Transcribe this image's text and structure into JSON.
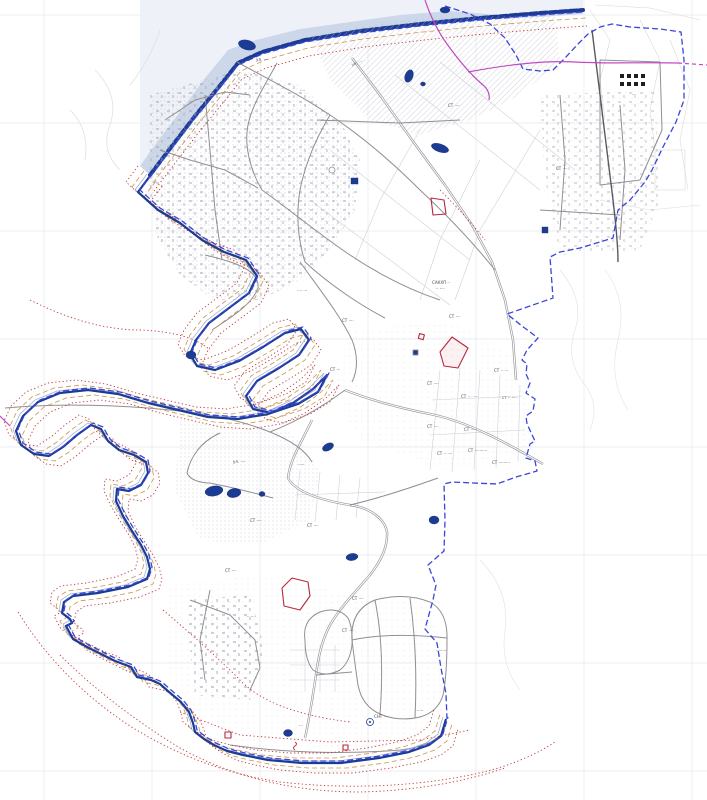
{
  "map": {
    "kind": "cadastral-boundary-plan",
    "colors": {
      "background": "#ffffff",
      "grid": "#e7e8ec",
      "terrain_outside": "#eef1f7",
      "water_light": "#ccd7ea",
      "water_navy": "#1c3c94",
      "water_edge": "#99a7d6",
      "boundary_blue": "#3b46d8",
      "zone_red": "#c23a3a",
      "zone_tan": "#c9964f",
      "route_magenta": "#c24ac2",
      "road_gray": "#8f8f94",
      "road_dark": "#5a5a60",
      "parcel_gray": "#cdd0d8",
      "contour_gray": "#dfe1e8",
      "urban_speckle": "#b9bfca",
      "building_gray": "#9aa0ac",
      "plot_red": "#b5283c",
      "label_gray": "#4a4a55"
    },
    "features": [
      {
        "name": "city-boundary",
        "style": "blue-dashed-line"
      },
      {
        "name": "shoreline",
        "style": "navy-solid-line"
      },
      {
        "name": "river",
        "style": "light-blue-band-with-navy-bank"
      },
      {
        "name": "protection-zone",
        "style": "red-dotted-line"
      },
      {
        "name": "coastal-strip-zone",
        "style": "tan-dashed-line"
      },
      {
        "name": "planned-route",
        "style": "magenta-line"
      },
      {
        "name": "road-network",
        "style": "gray-double-lines"
      },
      {
        "name": "built-up-area",
        "style": "gray-speckle-texture"
      },
      {
        "name": "ponds",
        "style": "navy-filled-shapes"
      },
      {
        "name": "red-outlined-plots",
        "style": "red-outline-polygons"
      },
      {
        "name": "railway",
        "style": "dark-gray-line"
      },
      {
        "name": "map-sheet-grid",
        "style": "light-gray-grid"
      }
    ],
    "labels": [
      {
        "text": "ул. ····",
        "x": 256,
        "y": 61,
        "rot": 0
      },
      {
        "text": "ул. ···",
        "x": 352,
        "y": 66,
        "rot": -20
      },
      {
        "text": "····",
        "x": 300,
        "y": 92,
        "rot": 0
      },
      {
        "text": "СТ ····",
        "x": 448,
        "y": 107,
        "rot": 0
      },
      {
        "text": "···",
        "x": 632,
        "y": 96,
        "rot": 0
      },
      {
        "text": "СТ ····",
        "x": 556,
        "y": 170,
        "rot": 0
      },
      {
        "text": "···· ···",
        "x": 297,
        "y": 292,
        "rot": 0
      },
      {
        "text": "САКХП ··",
        "x": 432,
        "y": 284,
        "rot": 0
      },
      {
        "text": "·· ····",
        "x": 436,
        "y": 290,
        "rot": 0
      },
      {
        "text": "СТ ····",
        "x": 342,
        "y": 322,
        "rot": 0
      },
      {
        "text": "СТ ····",
        "x": 449,
        "y": 318,
        "rot": 0
      },
      {
        "text": "СТ ···",
        "x": 330,
        "y": 371,
        "rot": 0
      },
      {
        "text": "СТ ····",
        "x": 427,
        "y": 385,
        "rot": 0
      },
      {
        "text": "СТ ·· ···",
        "x": 494,
        "y": 372,
        "rot": 0
      },
      {
        "text": "СТ ·· · ···",
        "x": 461,
        "y": 398,
        "rot": 0
      },
      {
        "text": "ст ·· ····",
        "x": 502,
        "y": 399,
        "rot": 0
      },
      {
        "text": "СТ ····",
        "x": 427,
        "y": 428,
        "rot": 0
      },
      {
        "text": "СТ ·····",
        "x": 464,
        "y": 431,
        "rot": 0
      },
      {
        "text": "СТ ·· ····",
        "x": 437,
        "y": 455,
        "rot": 0
      },
      {
        "text": "СТ ··········",
        "x": 468,
        "y": 452,
        "rot": 0
      },
      {
        "text": "СТ ·········",
        "x": 492,
        "y": 464,
        "rot": 0
      },
      {
        "text": "·····",
        "x": 298,
        "y": 466,
        "rot": 0
      },
      {
        "text": "ул. ····",
        "x": 233,
        "y": 463,
        "rot": 0
      },
      {
        "text": "СТ ····",
        "x": 250,
        "y": 522,
        "rot": 0
      },
      {
        "text": "СТ ····",
        "x": 307,
        "y": 527,
        "rot": 0
      },
      {
        "text": "СТ ····",
        "x": 225,
        "y": 572,
        "rot": 0
      },
      {
        "text": "СТ ····",
        "x": 352,
        "y": 600,
        "rot": 0
      },
      {
        "text": "·· ····",
        "x": 247,
        "y": 618,
        "rot": 0
      },
      {
        "text": "СТ ····",
        "x": 342,
        "y": 632,
        "rot": 0
      },
      {
        "text": "········",
        "x": 436,
        "y": 652,
        "rot": 0
      },
      {
        "text": "СНТ ····",
        "x": 374,
        "y": 718,
        "rot": 0
      },
      {
        "text": "···",
        "x": 299,
        "y": 727,
        "rot": 0
      },
      {
        "text": "·····",
        "x": 417,
        "y": 712,
        "rot": 0
      }
    ]
  }
}
